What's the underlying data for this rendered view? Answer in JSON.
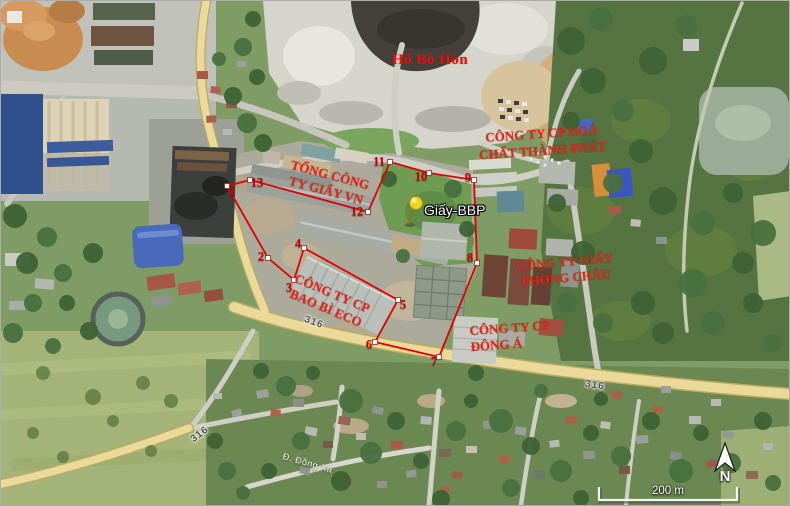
{
  "map": {
    "lake_label": "Hồ Bô Hòn",
    "pin": {
      "label": "Giấy-BBP"
    },
    "companies": {
      "giay_vn_line1": "TỔNG CÔNG",
      "giay_vn_line2": "TY GIẤY VN",
      "thanh_phat_line1": "CÔNG TY CP HOÁ",
      "thanh_phat_line2": "CHẤT THÀNH PHÁT",
      "phong_chau_line1": "CÔNG TY GIẤY",
      "phong_chau_line2": "PHONG CHÂU",
      "dong_a_line1": "CÔNG TY CP",
      "dong_a_line2": "ĐÔNG Á",
      "bao_bi_eco_line1": "CÔNG TY CP",
      "bao_bi_eco_line2": "BAO BÌ ECO"
    },
    "road_labels": {
      "route_1": "316",
      "route_2": "316",
      "route_3": "316",
      "street": "Đ. Đồng Xã"
    },
    "scale_bar": {
      "label": "200 m"
    },
    "compass": {
      "label": "N"
    },
    "boundary_vertices": [
      "1",
      "2",
      "3",
      "4",
      "5",
      "6",
      "7",
      "8",
      "9",
      "10",
      "11",
      "12",
      "13"
    ],
    "colors": {
      "annotation_red": "#e00000",
      "pin_yellow": "#ecd51e",
      "road_yellow": "#ead999"
    }
  }
}
